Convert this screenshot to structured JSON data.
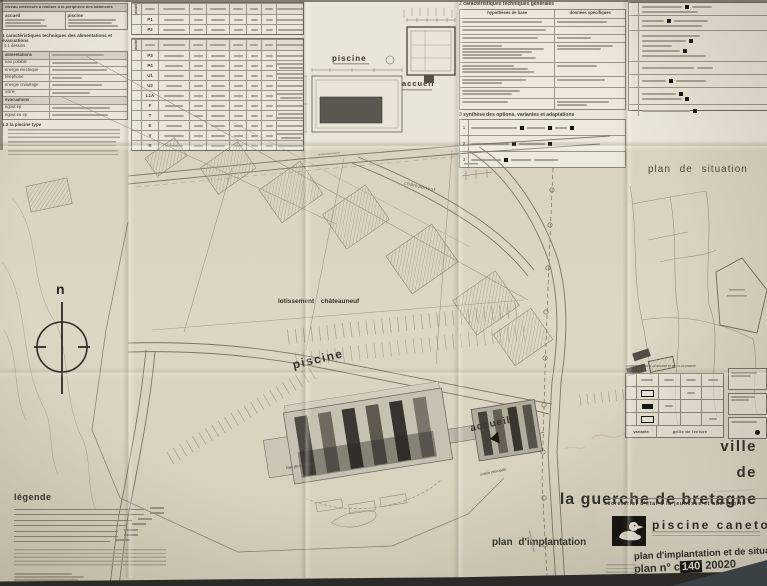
{
  "colors": {
    "paper": "#d8d1bf",
    "panel": "#e9e5d8",
    "ink": "#3c382f",
    "accent_black": "#141210"
  },
  "panels": {
    "niveaux": {
      "title": "niveau extérieurs à réaliser à la périphérie des bâtiments",
      "groups": [
        "accueil",
        "piscine"
      ]
    },
    "alim": {
      "heading": "1  caractéristiques techniques des alimentations et évacuations",
      "subheading": "1.1 dessins",
      "rows": [
        "alimentations",
        "eau potable",
        "énergie électrique",
        "téléphone",
        "énergie chauffage",
        "voirie",
        "évacuations",
        "égout ep",
        "égout eu ep"
      ],
      "footer_heading": "1.2 la piscine type"
    },
    "reseaux": {
      "group_top": "accueil",
      "group_bottom": "piscine",
      "codes_top": [
        "P1",
        "P2"
      ],
      "codes_bottom": [
        "P3",
        "P4",
        "U1",
        "U2",
        "L1A",
        "F",
        "T",
        "E",
        "V",
        "B"
      ]
    },
    "schema": {
      "piscine": "piscine",
      "accueil": "accueil"
    },
    "generales": {
      "heading": "2  caractéristiques techniques générales",
      "col_left": "hypothèses de base",
      "col_right": "données spécifiques"
    },
    "synthese": {
      "heading": "3  synthèse des options, variantes et adaptations",
      "row_numbers": [
        "1",
        "2",
        "3"
      ]
    }
  },
  "plan": {
    "situation_title": "plan de situation",
    "implantation_title": "plan d'implantation",
    "lotissement": "lotissement châteauneuf",
    "road_chateauneuf": "châteauneuf",
    "piscine": "piscine",
    "accueil": "accueil",
    "bac": "bac jeux d'eau",
    "entree": "entrée principale",
    "north": "n"
  },
  "legend": {
    "title": "légende"
  },
  "titleblock": {
    "grille": {
      "header": "l'orientation du u.25 accueil et de l'u.25 piscine",
      "variante": "variante",
      "grille_de_lecture": "grille de lecture"
    },
    "city": [
      "ville",
      "de",
      "la guerche de bretagne"
    ],
    "ministry": "secrétariat d'état à la jeunesse et aux sports",
    "project": "piscine caneton",
    "doc_title": "plan d'implantation et de situation",
    "plan_no_label": "plan n°",
    "plan_no_prefix": "c",
    "plan_no_inverted": "140",
    "plan_no_suffix": "20020"
  }
}
